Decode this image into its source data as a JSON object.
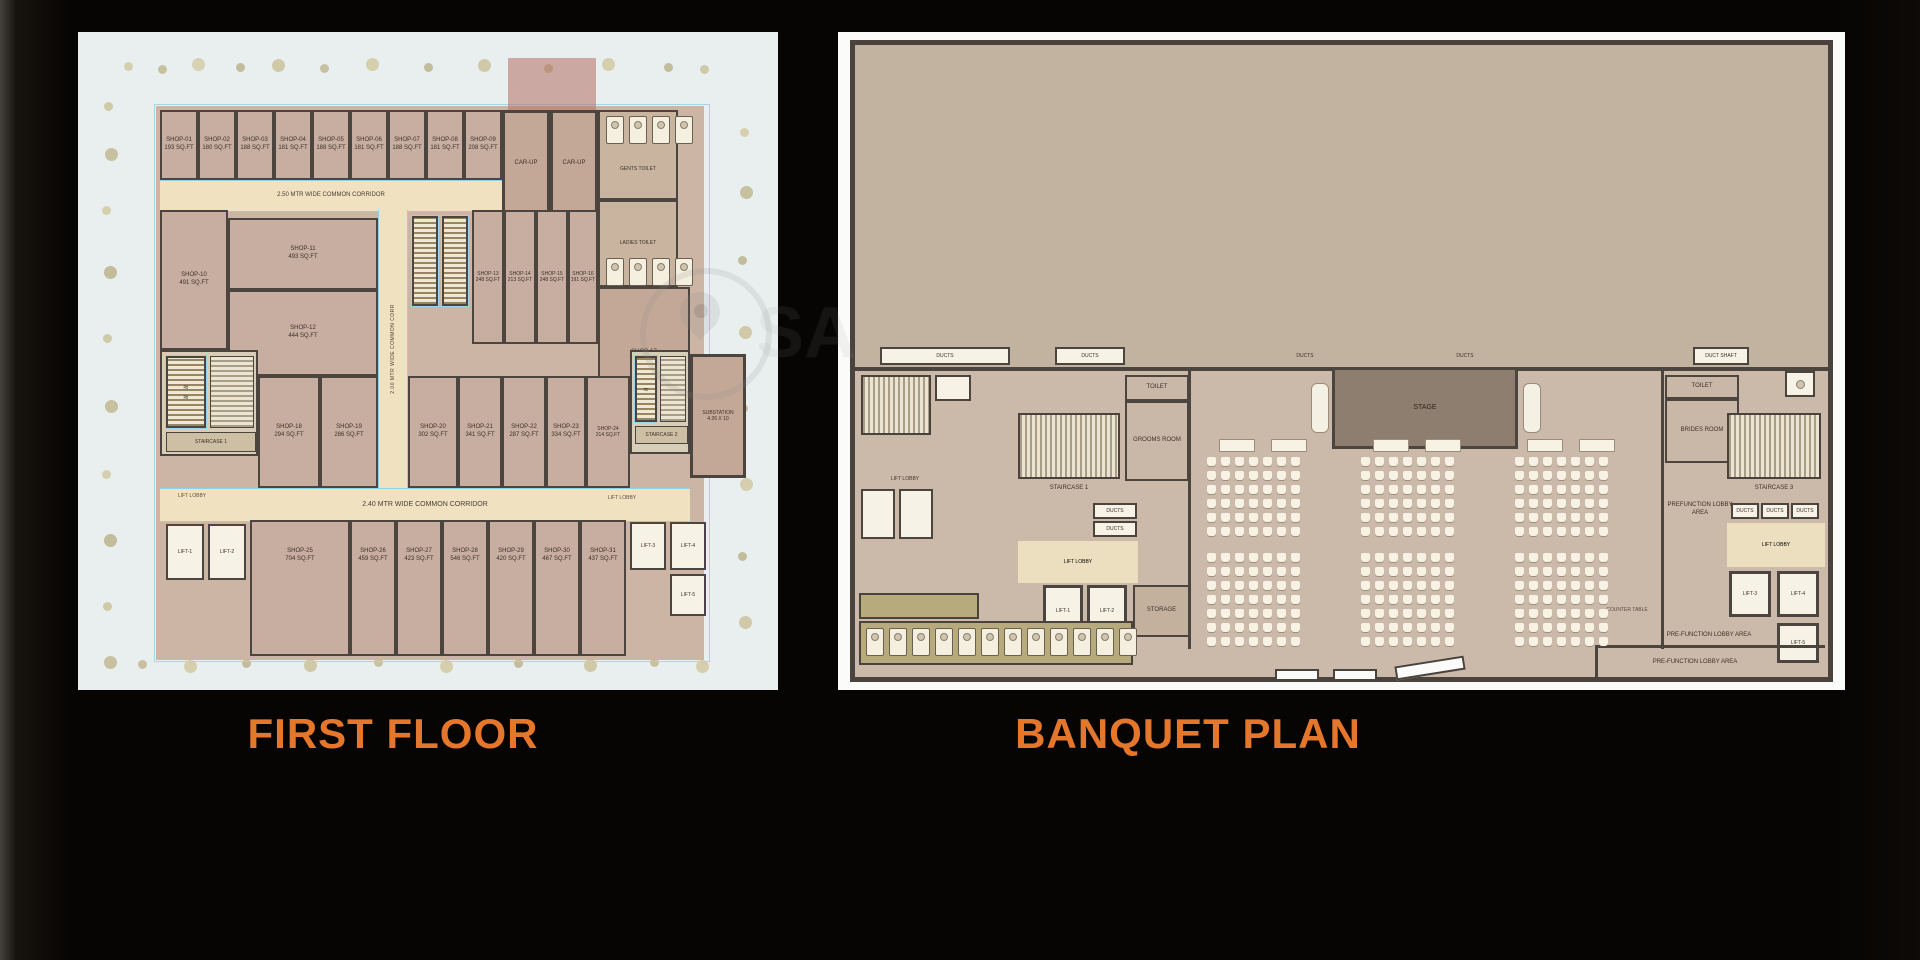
{
  "page": {
    "bg": "#070503",
    "accent": "#e4772c"
  },
  "titles": {
    "left": "FIRST FLOOR",
    "right": "BANQUET PLAN"
  },
  "watermark": {
    "text": "SA"
  },
  "first_floor": {
    "corridor_top": "2.50 MTR WIDE COMMON CORRIDOR",
    "corridor_bottom": "2.40 MTR WIDE COMMON CORRIDOR",
    "corridor_vertical": "2.00 MTR WIDE COMMON CORR",
    "lift_lobby": "LIFT LOBBY",
    "car_up": "CAR-UP",
    "gents_toilet": "GENTS TOILET",
    "ladies_toilet": "LADIES TOILET",
    "staircase1": "STAIRCASE 1",
    "staircase2": "STAIRCASE 2",
    "substation": "SUBSTATION",
    "substation_dim": "4.26 X 10",
    "lifts": [
      "LIFT-1",
      "LIFT-2",
      "LIFT-3",
      "LIFT-4",
      "LIFT-5"
    ],
    "top_shops": [
      {
        "name": "SHOP-01",
        "area": "193 SQ.FT"
      },
      {
        "name": "SHOP-02",
        "area": "180 SQ.FT"
      },
      {
        "name": "SHOP-03",
        "area": "188 SQ.FT"
      },
      {
        "name": "SHOP-04",
        "area": "181 SQ.FT"
      },
      {
        "name": "SHOP-05",
        "area": "188 SQ.FT"
      },
      {
        "name": "SHOP-06",
        "area": "181 SQ.FT"
      },
      {
        "name": "SHOP-07",
        "area": "188 SQ.FT"
      },
      {
        "name": "SHOP-08",
        "area": "181 SQ.FT"
      },
      {
        "name": "SHOP-09",
        "area": "208 SQ.FT"
      }
    ],
    "mid_left_shops": [
      {
        "name": "SHOP-10",
        "area": "491 SQ.FT"
      },
      {
        "name": "SHOP-11",
        "area": "493 SQ.FT"
      },
      {
        "name": "SHOP-12",
        "area": "444 SQ.FT"
      }
    ],
    "mid_right_shops": [
      {
        "name": "SHOP-13",
        "area": "248 SQ.FT"
      },
      {
        "name": "SHOP-14",
        "area": "213 SQ.FT"
      },
      {
        "name": "SHOP-15",
        "area": "248 SQ.FT"
      },
      {
        "name": "SHOP-16",
        "area": "191 SQ.FT"
      }
    ],
    "shop17": {
      "name": "SHOP-17",
      "area": "770 SQ.FT"
    },
    "mid_row_shops": [
      {
        "name": "SHOP-18",
        "area": "294 SQ.FT"
      },
      {
        "name": "SHOP-19",
        "area": "286 SQ.FT"
      },
      {
        "name": "SHOP-20",
        "area": "302 SQ.FT"
      },
      {
        "name": "SHOP-21",
        "area": "341 SQ.FT"
      },
      {
        "name": "SHOP-22",
        "area": "287 SQ.FT"
      },
      {
        "name": "SHOP-23",
        "area": "334 SQ.FT"
      },
      {
        "name": "SHOP-24",
        "area": "314 SQ.FT"
      }
    ],
    "bottom_shops": [
      {
        "name": "SHOP-25",
        "area": "704 SQ.FT"
      },
      {
        "name": "SHOP-26",
        "area": "459 SQ.FT"
      },
      {
        "name": "SHOP-27",
        "area": "423 SQ.FT"
      },
      {
        "name": "SHOP-28",
        "area": "546 SQ.FT"
      },
      {
        "name": "SHOP-29",
        "area": "420 SQ.FT"
      },
      {
        "name": "SHOP-30",
        "area": "467 SQ.FT"
      },
      {
        "name": "SHOP-31",
        "area": "437 SQ.FT"
      }
    ]
  },
  "banquet": {
    "stage": "STAGE",
    "ducts": "DUCTS",
    "duct_shaft": "DUCT SHAFT",
    "toilet": "TOILET",
    "grooms_room": "GROOMS ROOM",
    "brides_room": "BRIDES ROOM",
    "staircase1": "STAIRCASE 1",
    "staircase3": "STAIRCASE 3",
    "lift_lobby": "LIFT LOBBY",
    "storage": "STORAGE",
    "lifts": [
      "LIFT-1",
      "LIFT-2",
      "LIFT-3",
      "LIFT-4",
      "LIFT-5"
    ],
    "prefunction": "PREFUNCTION LOBBY AREA",
    "pre_function": "PRE-FUNCTION LOBBY AREA",
    "counter_table": "COUNTER TABLE"
  }
}
